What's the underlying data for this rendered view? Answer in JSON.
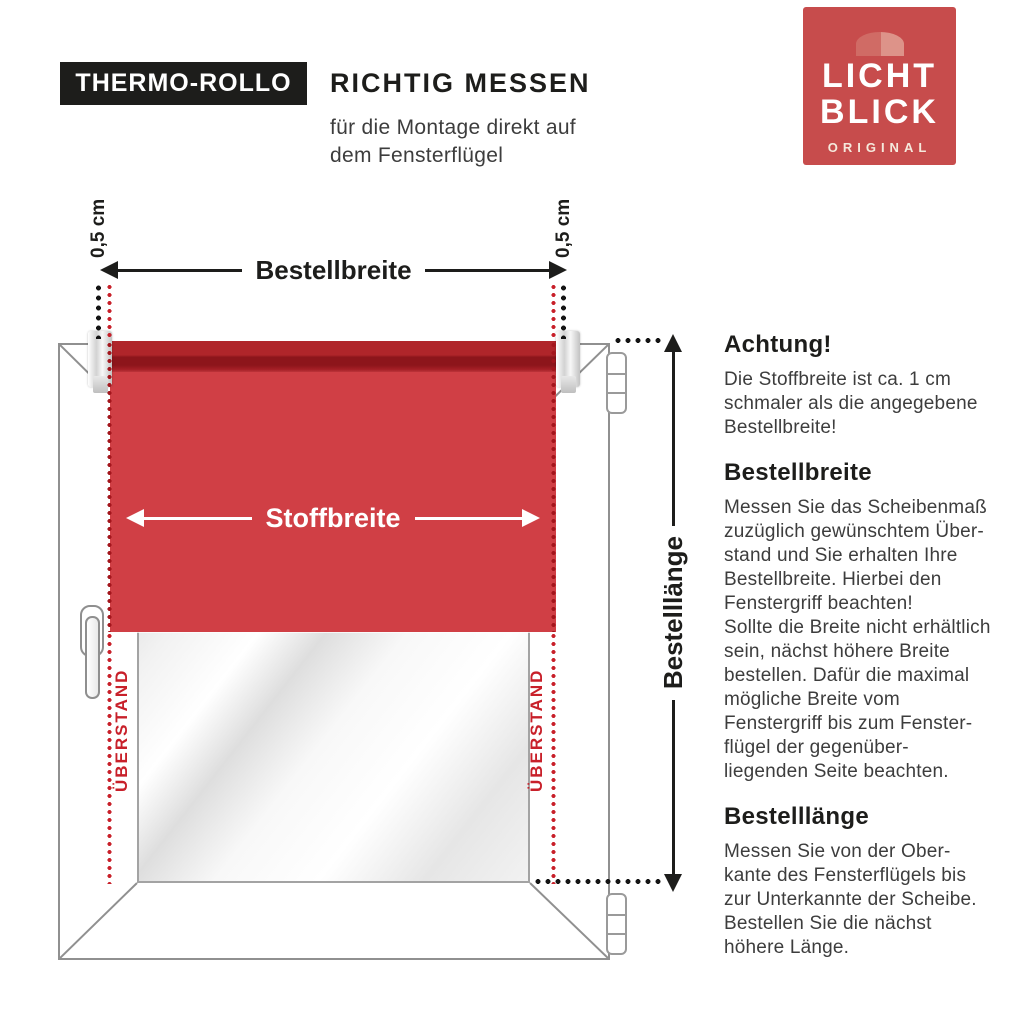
{
  "header": {
    "product_label": "THERMO-ROLLO",
    "title": "RICHTIG MESSEN",
    "subtitle": "für die Montage direkt auf\ndem Fensterflügel"
  },
  "logo": {
    "line1": "LICHT",
    "line2": "BLICK",
    "subline": "ORIGINAL",
    "bg_color": "#c74c4c",
    "awning_color_left": "#d06b65",
    "awning_color_right": "#dd9389"
  },
  "diagram": {
    "labels": {
      "bestellbreite": "Bestellbreite",
      "stoffbreite": "Stoffbreite",
      "bestelllaenge": "Bestelllänge",
      "offset_left": "0,5 cm",
      "offset_right": "0,5 cm",
      "ueberstand_left": "ÜBERSTAND",
      "ueberstand_right": "ÜBERSTAND"
    },
    "colors": {
      "fabric_red": "#d03f45",
      "roller_band_dark": "#8d151b",
      "roller_band_mid": "#b0252a",
      "accent_red": "#c8202a",
      "measure_black": "#141414",
      "frame_stroke": "#909090"
    }
  },
  "instructions": {
    "sections": [
      {
        "heading": "Achtung!",
        "text": "Die Stoffbreite ist ca. 1 cm\nschmaler als die angegebene\nBestellbreite!"
      },
      {
        "heading": "Bestellbreite",
        "text": "Messen Sie das Scheibenmaß\nzuzüglich gewünschtem Über-\nstand und Sie erhalten Ihre\nBestellbreite. Hierbei den\nFenstergriff beachten!\nSollte die Breite nicht erhältlich\nsein, nächst höhere Breite\nbestellen. Dafür die maximal\nmögliche Breite vom\nFenstergriff bis zum Fenster-\nflügel der gegenüber-\nliegenden Seite beachten."
      },
      {
        "heading": "Bestelllänge",
        "text": "Messen Sie von der Ober-\nkante des Fensterflügels bis\nzur Unterkannte der Scheibe.\nBestellen Sie die nächst\nhöhere Länge."
      }
    ]
  }
}
